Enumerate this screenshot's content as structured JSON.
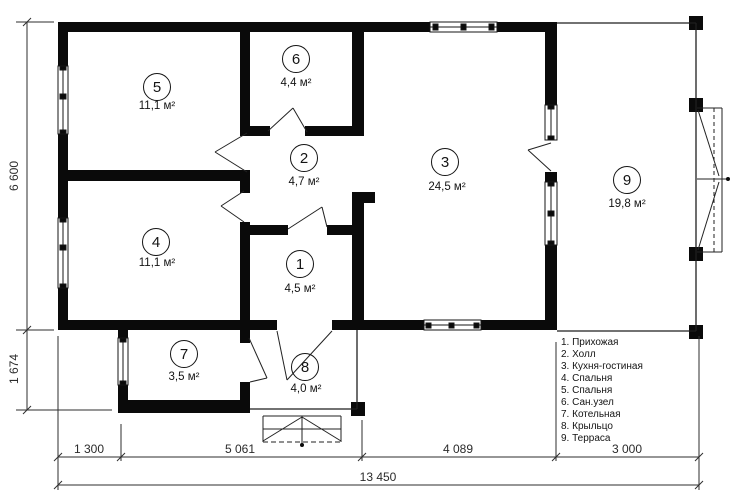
{
  "rooms": [
    {
      "number": "1",
      "area": "4,5 м²"
    },
    {
      "number": "2",
      "area": "4,7 м²"
    },
    {
      "number": "3",
      "area": "24,5 м²"
    },
    {
      "number": "4",
      "area": "11,1 м²"
    },
    {
      "number": "5",
      "area": "11,1 м²"
    },
    {
      "number": "6",
      "area": "4,4 м²"
    },
    {
      "number": "7",
      "area": "3,5 м²"
    },
    {
      "number": "8",
      "area": "4,0 м²"
    },
    {
      "number": "9",
      "area": "19,8 м²"
    }
  ],
  "legend": {
    "items": [
      "1. Прихожая",
      "2. Холл",
      "3. Кухня-гостиная",
      "4. Спальня",
      "5. Спальня",
      "6. Сан.узел",
      "7. Котельная",
      "8. Крыльцо",
      "9. Терраса"
    ]
  },
  "dimensions": {
    "main_height": "6 600",
    "annex_height": "1 674",
    "bottom_segments": [
      "1 300",
      "5 061",
      "4 089",
      "3 000"
    ],
    "total_width": "13 450"
  },
  "colors": {
    "wall": "#0a0a0a",
    "line": "#1f1f1f",
    "background": "#ffffff",
    "text": "#141414"
  }
}
